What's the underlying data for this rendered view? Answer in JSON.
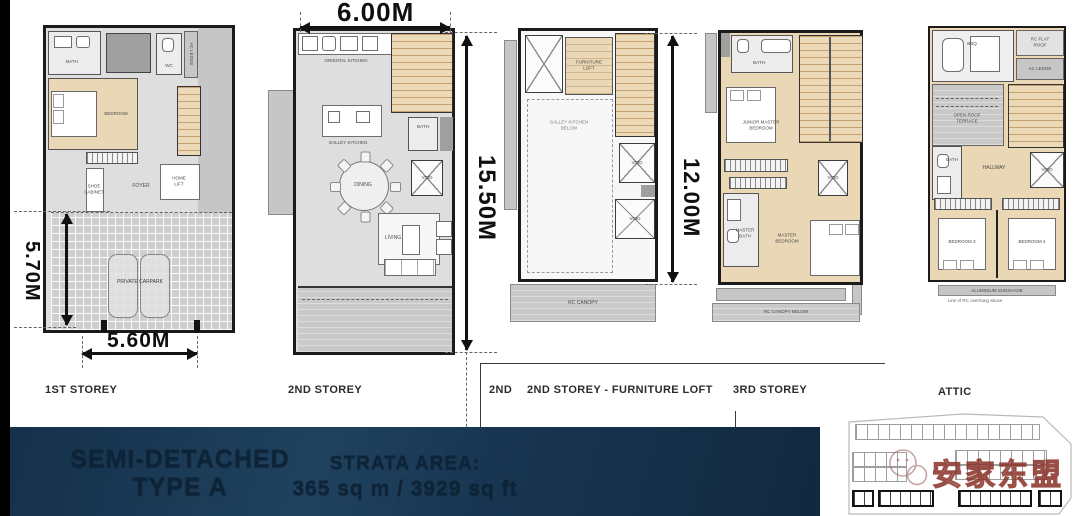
{
  "banner": {
    "title_line1": "SEMI-DETACHED",
    "title_line2": "TYPE A",
    "strata_label": "STRATA AREA:",
    "strata_value": "365 sq m / 3929 sq ft",
    "bg_color": "#1c3a52",
    "text_color": "#0d2337"
  },
  "watermark": {
    "brand_text": "安家东盟",
    "icon": "wechat-logo",
    "color": "#8b352b"
  },
  "colors": {
    "wall": "#1b1b1b",
    "wood_floor": "#ead7b5",
    "light_floor": "#dedede",
    "ledge_gray": "#c6c6c6",
    "dim_black": "#111111"
  },
  "plans": [
    {
      "storey_label": "1ST STOREY",
      "dim_vertical": "5.70M",
      "dim_bottom": "5.60M",
      "rooms": {
        "bath": "BATH",
        "wc": "WC",
        "ac_ledge": "AC LEDGE",
        "bedroom": "BEDROOM",
        "shoe_cabinet": "SHOE\nCABINET",
        "foyer": "FOYER",
        "home_lift": "HOME\nLIFT",
        "carpark": "PRIVATE CARPARK"
      }
    },
    {
      "storey_label": "2ND STOREY",
      "dim_top": "6.00M",
      "dim_vertical": "15.50M",
      "rooms": {
        "kitchen_top": "ORIENTAL KITCHEN",
        "kitchen": "GALLEY KITCHEN",
        "bath": "BATH",
        "void": "VOID",
        "dining": "DINING",
        "living": "LIVING"
      }
    },
    {
      "storey_label_prefix": "2ND",
      "storey_label": "2ND STOREY - FURNITURE LOFT",
      "dim_vertical": "12.00M",
      "rooms": {
        "furniture_loft": "FURNITURE\nLOFT",
        "kitchen_below": "GALLEY KITCHEN\nBELOW",
        "void_1": "VOID",
        "void_2": "VOID",
        "rc_canopy": "RC CANOPY"
      }
    },
    {
      "storey_label": "3RD STOREY",
      "rooms": {
        "bath": "BATH",
        "junior_master": "JUNIOR MASTER\nBEDROOM",
        "void": "VOID",
        "master_bath": "MASTER\nBATH",
        "master_bedroom": "MASTER\nBEDROOM",
        "rc_canopy_below": "RC CANOPY BELOW"
      }
    },
    {
      "storey_label": "ATTIC",
      "rooms": {
        "bbq": "BBQ",
        "rc_flat_roof": "RC FLAT ROOF",
        "ac_ledge": "AC LEDGE",
        "open_roof_terrace": "OPEN ROOF\nTERRACE",
        "hallway": "HALLWAY",
        "bath": "BATH",
        "void": "VOID",
        "bedroom_3": "BEDROOM 3",
        "bedroom_4": "BEDROOM 4",
        "sunshade": "ALUMINIUM SUNSHADE",
        "note": "Line of RC overhang above"
      }
    }
  ]
}
